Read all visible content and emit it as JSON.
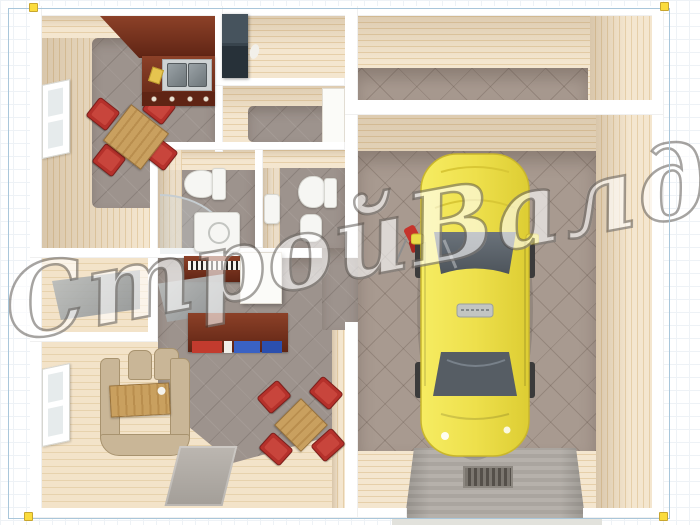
{
  "scene": {
    "description": "3D top-down architectural render of a single-storey house with kitchen, entrance hall, two bathrooms, living room, storage room and an attached garage with a yellow car on a ramp",
    "watermark": {
      "text": "СтройВалдай"
    }
  },
  "objects": [
    "kitchen-counter",
    "kitchen-sink",
    "kitchen-stove",
    "dining-table-red-chairs",
    "refrigerator",
    "toilet",
    "shower-cabin",
    "washing-machine",
    "second-toilet",
    "bidet",
    "piano",
    "white-cabinet",
    "writing-desk",
    "books",
    "sofa",
    "coffee-table",
    "living-dining-set",
    "rug",
    "windows",
    "yellow-car",
    "garage-ramp",
    "floor-drain",
    "red-cart"
  ],
  "colors": {
    "wall_white": "#ffffff",
    "cream": "#f4e6cf",
    "cream_dark": "#e6cfa9",
    "floor_gray": "#9d938d",
    "garage_floor": "#a89a90",
    "wood_floor": "#f3e3c9",
    "wood_floor_line": "#e7d2ad",
    "mahogany": "#8c4128",
    "mahogany_dark": "#5f2414",
    "chair_red": "#b5312b",
    "wood": "#c9a05f",
    "sofa": "#c9b697",
    "fridge_top": "#46535d",
    "fridge_bottom": "#273139",
    "glass_gray": "#aab0b1",
    "car_yellow": "#eee04c",
    "car_yellow_deep": "#e0d036",
    "car_glass": "#5a626a",
    "ramp": "#b6b1ab",
    "rug": "#b3aea8",
    "frame_blue": "#a9c6da",
    "pin_yellow": "#fbdc3d",
    "white_fixture": "#f6f6f3",
    "watermark_ink": "rgba(66,60,54,0.55)"
  }
}
